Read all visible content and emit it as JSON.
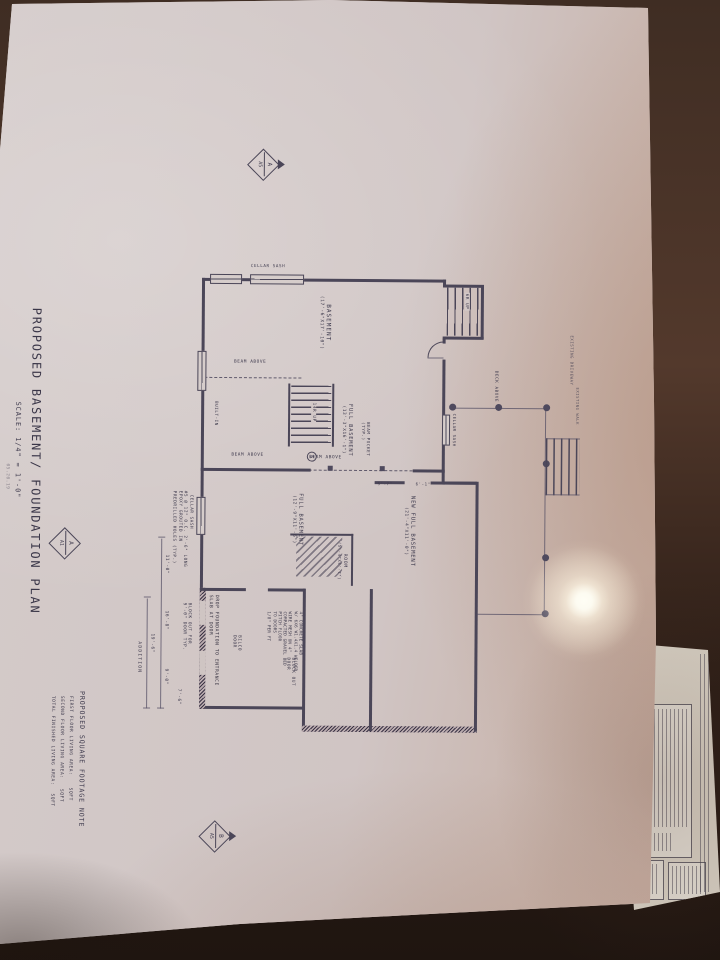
{
  "colors": {
    "table": "#33231b",
    "paper": "#d1c7c6",
    "ink": "#4b4658",
    "glare": "#fff8e7"
  },
  "plan": {
    "title": "PROPOSED BASEMENT/ FOUNDATION PLAN",
    "scale": "SCALE: 1/4\" = 1'-0\"",
    "sub_note": "05.20.19",
    "rooms": [
      {
        "name": "BASEMENT",
        "dims": "(17'-6\"X17'-10\")"
      },
      {
        "name": "FULL BASEMENT",
        "dims": "(13'-3\"X16'-1\")"
      },
      {
        "name": "FULL BASEMENT",
        "dims": "(12'-9\"X11'-6\")"
      },
      {
        "name": "NEW FULL BASEMENT",
        "dims": "(21'-4\"X11'-0\")"
      },
      {
        "name": "ROOM",
        "dims": "(5'-4\"X4'-7\")"
      }
    ],
    "labels": {
      "cellar_sash": "CELLAR SASH",
      "beam_above": "BEAM ABOVE",
      "beam_pocket_1": "BEAM POCKET",
      "beam_pocket_2": "(TYP.)",
      "deck_above": "DECK ABOVE",
      "bilco_door": "BILCO DOOR",
      "block_out_1": "BLOCK OUT",
      "block_out_2": "DOOR",
      "block_out_for_1": "BLOCK OUT FOR",
      "block_out_for_2": "9'-0\" DOOR TYP.",
      "built_in": "BUILT-IN",
      "up_6r": "6R UP",
      "up_14r": "14R UP",
      "addition": "ADDITION",
      "existing_1": "EXISTING DRIVEWAY",
      "existing_2": "EXISTING WALK",
      "drop_foundation_1": "DROP FOUNDATION TO ENTRANCE",
      "drop_foundation_2": "SLAB AT DOOR",
      "column_mark": "5"
    },
    "dims": {
      "d57": "5'-7\"",
      "d61": "6'-1\"",
      "d168": "16'-8\"",
      "d90": "9'-0\"",
      "d196": "19'-6\"",
      "d76": "7'-6\"",
      "d110": "11'-0\""
    },
    "notes": {
      "epoxy": [
        "#5 @ 12\" O.C. 2'-6\" LONG",
        "EPOXY GROUTED IN",
        "PREDRILLED HOLES (TYP.)"
      ],
      "slab": [
        "4\" CONCRETE SLAB",
        "W/ 6X6 W1.4X1.4 WELDED",
        "WIRE MESH ON 4\"",
        "COMPACTED GRAVEL BED",
        "PITCH FLOOR",
        "TO DOORS",
        "1/8\" PER FT"
      ]
    },
    "sqft_note": {
      "heading": "PROPOSED SQUARE FOOTAGE NOTE",
      "rows": [
        {
          "label": "FIRST FLOOR LIVING AREA:",
          "suffix": "SQFT"
        },
        {
          "label": "SECOND FLOOR LIVING AREA:",
          "suffix": "SQFT"
        },
        {
          "label": "TOTAL FINISHED LIVING AREA:",
          "suffix": "SQFT"
        }
      ]
    },
    "markers": {
      "section_a": {
        "top": "A",
        "bottom": "A5"
      },
      "section_b": {
        "top": "B",
        "bottom": "A5"
      },
      "title_bubble": {
        "top": "A",
        "bottom": "A1"
      }
    }
  }
}
